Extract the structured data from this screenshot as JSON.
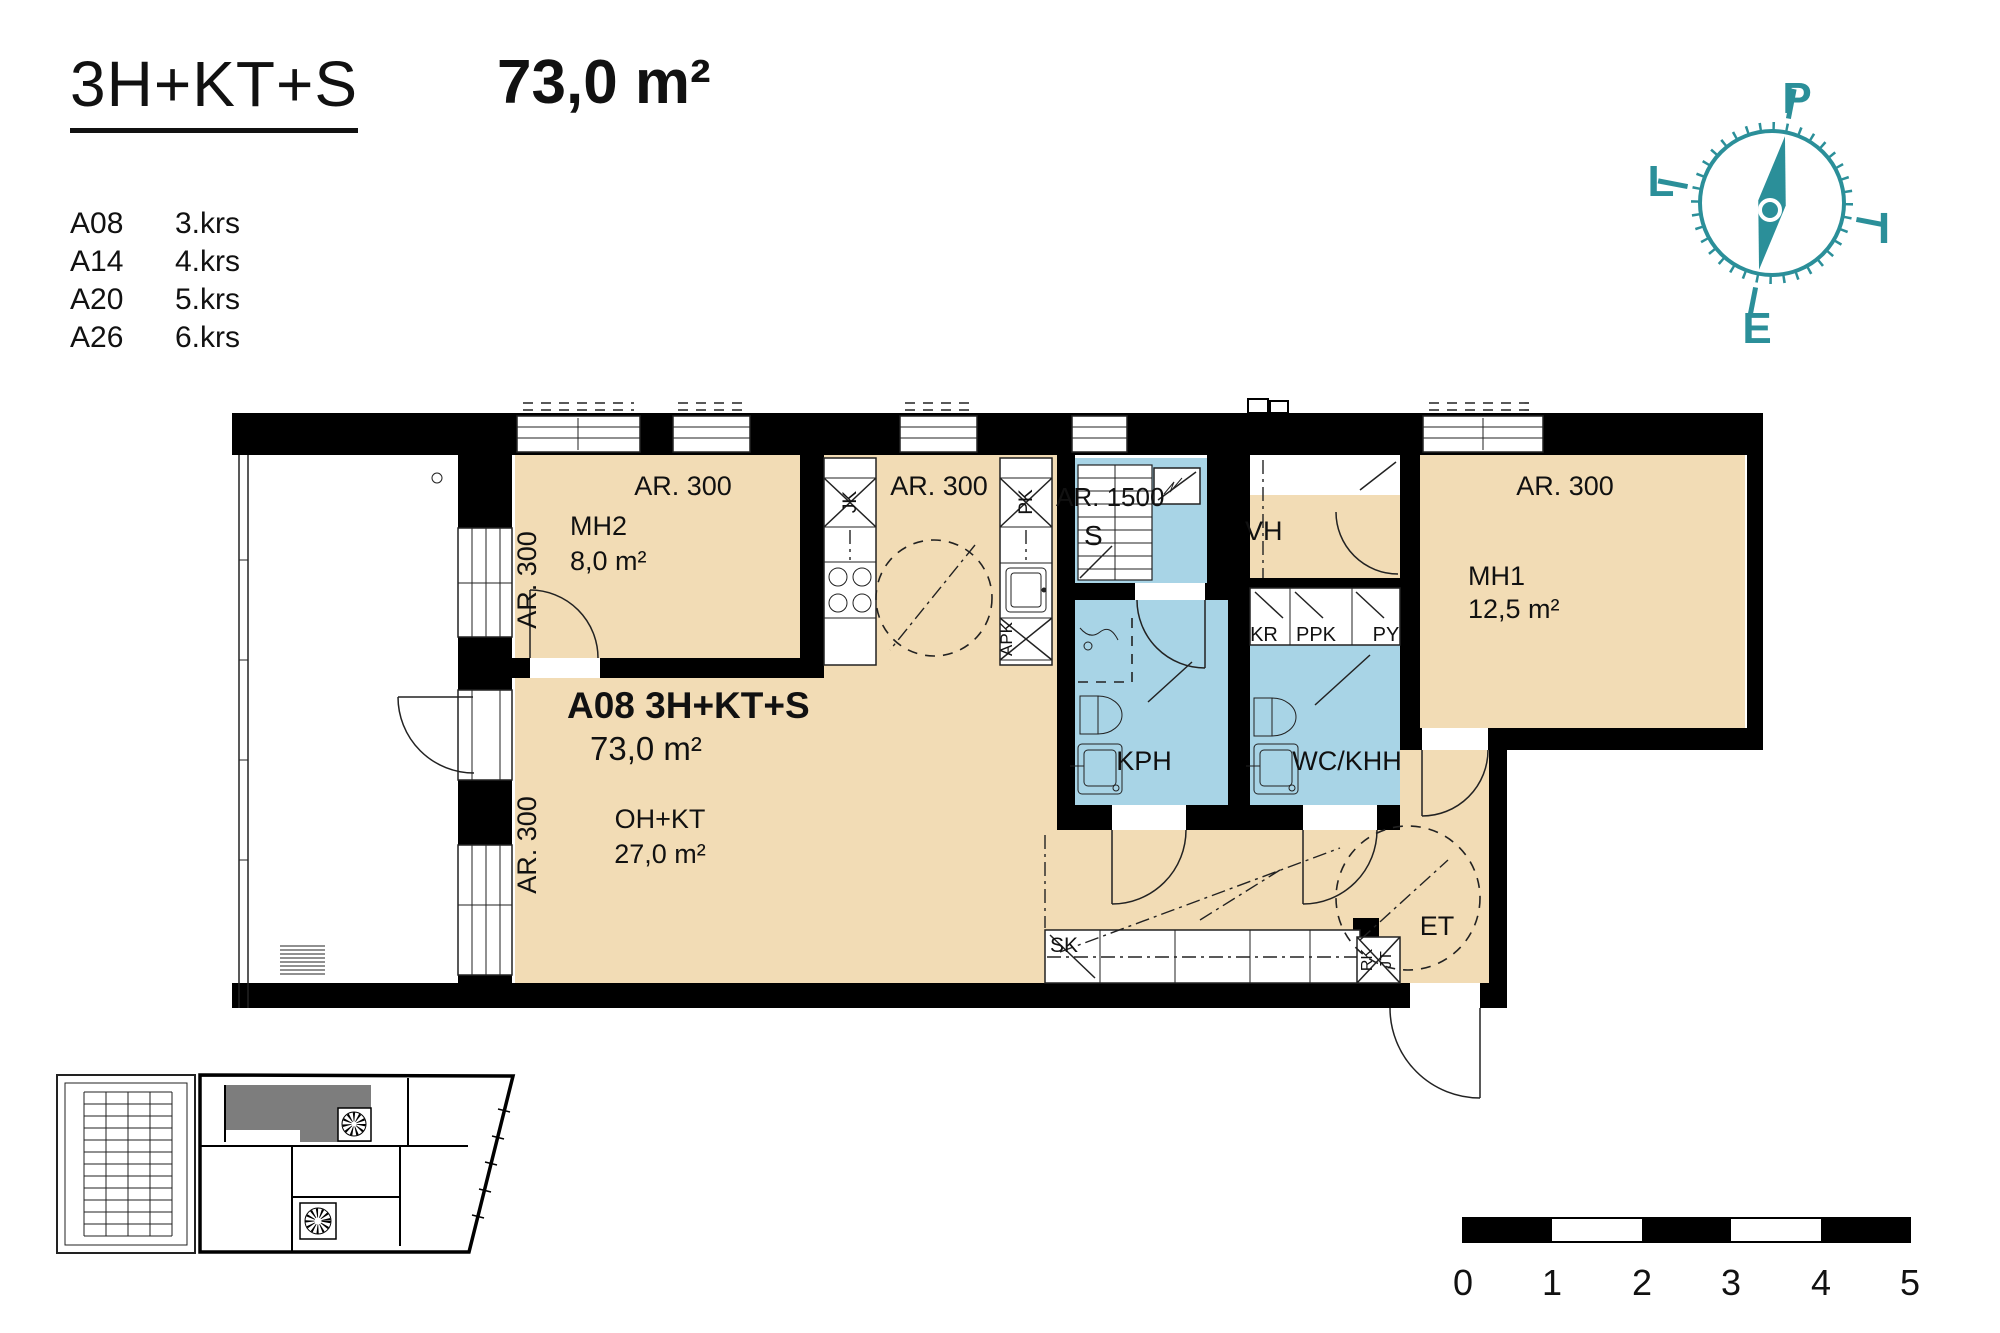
{
  "header": {
    "layout_type": "3H+KT+S",
    "area": "73,0 m²",
    "units": [
      {
        "id": "A08",
        "floor": "3.krs"
      },
      {
        "id": "A14",
        "floor": "4.krs"
      },
      {
        "id": "A20",
        "floor": "5.krs"
      },
      {
        "id": "A26",
        "floor": "6.krs"
      }
    ]
  },
  "compass": {
    "north": "P",
    "east": "I",
    "south": "E",
    "west": "L",
    "color": "#2b8f99"
  },
  "apartment": {
    "title": "A08 3H+KT+S",
    "area": "73,0 m²"
  },
  "rooms": [
    {
      "name": "MH2",
      "area": "8,0 m²"
    },
    {
      "name": "MH1",
      "area": "12,5 m²"
    },
    {
      "name": "OH+KT",
      "area": "27,0 m²"
    },
    {
      "name": "KPH"
    },
    {
      "name": "WC/KHH"
    },
    {
      "name": "S"
    },
    {
      "name": "VH"
    },
    {
      "name": "ET"
    }
  ],
  "plan_labels": {
    "ar300": "AR. 300",
    "ar1500": "AR. 1500",
    "jk": "JK",
    "pk": "PK",
    "apk": "APK",
    "kr": "KR",
    "ppk": "PPK",
    "py": "PY",
    "sk": "SK",
    "rk": "RK",
    "jt": "JT"
  },
  "scale_bar": {
    "ticks": [
      "0",
      "1",
      "2",
      "3",
      "4",
      "5"
    ]
  },
  "colors": {
    "room": "#f2dcb5",
    "wet_room": "#a8d4e6",
    "wall": "#000000",
    "key_highlight": "#7d7d7d"
  }
}
